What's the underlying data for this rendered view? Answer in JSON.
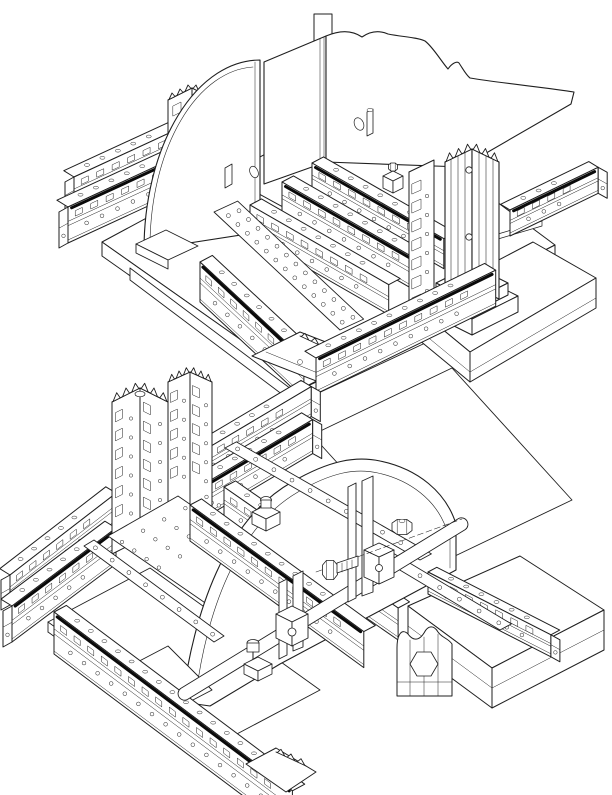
{
  "canvas": {
    "width": 612,
    "height": 795,
    "background": "#ffffff",
    "line_color": "#1f1f1f",
    "groove_color": "#0a0a0a"
  },
  "figures": [
    {
      "id": "assembly-top",
      "description": "Isometric CAD line drawing of a modular fixture assembly: quarter-circle gusset plate, bent sheet panel with wavy edge, perforated slotted rails, fluted clamping column on a stepped pedestal and flat base plates"
    },
    {
      "id": "assembly-bottom",
      "description": "Isometric CAD line drawing of a modular fixture assembly: tall perforated upright column, dome-shaped gusset plate, clamp posts with hex bolts and nuts, diagonal drilled straps and perforated rails on base plates"
    }
  ]
}
